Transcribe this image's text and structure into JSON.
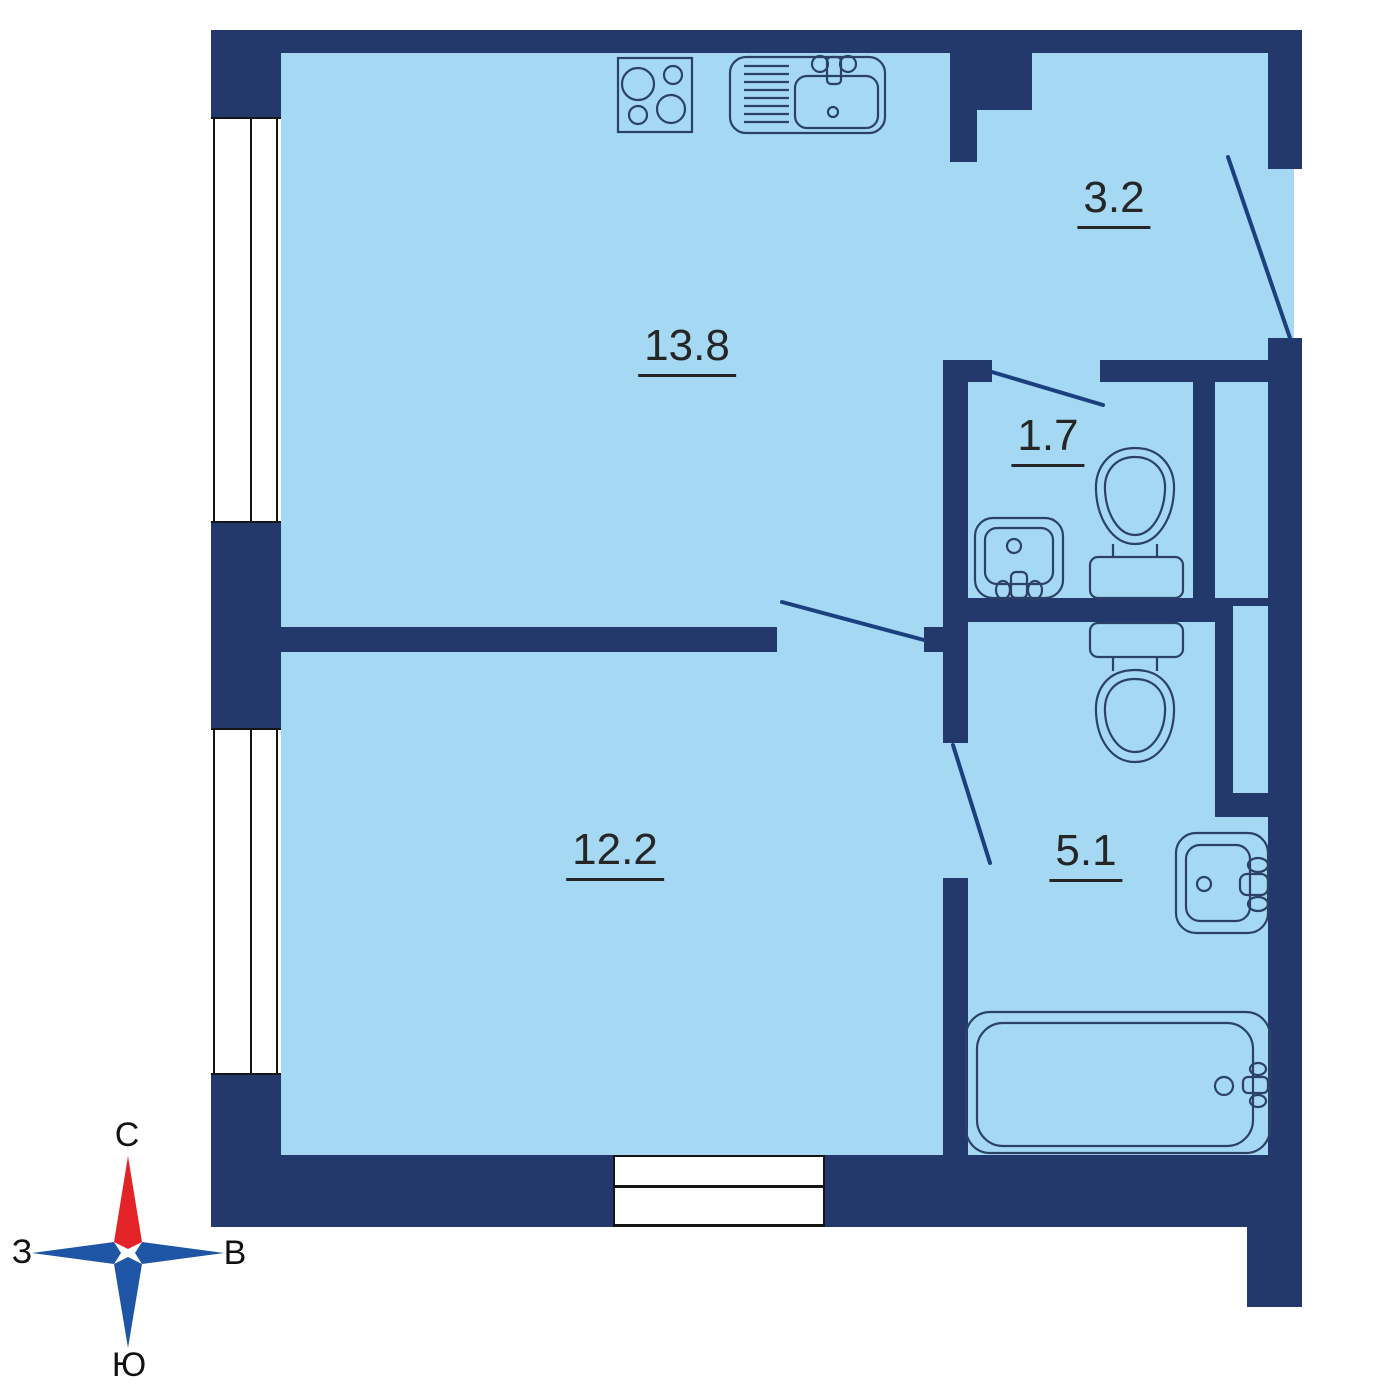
{
  "rooms": {
    "kitchen_living": {
      "area": "13.8"
    },
    "hallway": {
      "area": "3.2"
    },
    "wc": {
      "area": "1.7"
    },
    "bedroom": {
      "area": "12.2"
    },
    "bathroom": {
      "area": "5.1"
    }
  },
  "compass": {
    "north": "С",
    "south": "Ю",
    "west": "З",
    "east": "В"
  },
  "fixtures": {
    "kitchen": [
      "stove-icon",
      "kitchen-sink-icon"
    ],
    "wc": [
      "corner-sink-icon",
      "toilet-icon"
    ],
    "bathroom": [
      "toilet-icon",
      "wall-sink-icon",
      "bathtub-icon"
    ],
    "openings": [
      "entrance-door",
      "wc-door",
      "room-door",
      "bathroom-door",
      "window-left-1",
      "window-left-2",
      "balcony-door"
    ]
  },
  "colors": {
    "wall": "#24396b",
    "floor": "#a5d8f3",
    "fixture_outline": "#2c4166",
    "door_leaf": "#1c3f7f",
    "window_frame": "#141414",
    "label_text": "#262626",
    "compass_north": "#e42328",
    "compass_other": "#1e56a5",
    "background": "#ffffff"
  }
}
